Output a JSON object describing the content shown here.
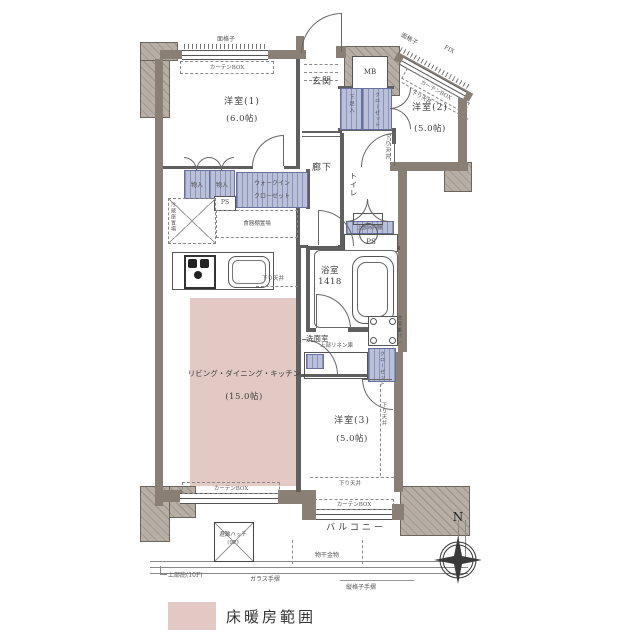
{
  "rooms": {
    "y1": {
      "name": "洋室(1)",
      "size": "(6.0帖)"
    },
    "y2": {
      "name": "洋室(2)",
      "size": "(5.0帖)"
    },
    "y3": {
      "name": "洋室(3)",
      "size": "(5.0帖)"
    },
    "ldk": {
      "name": "リビング・ダイニング・キッチン",
      "size": "(15.0帖)"
    },
    "genkan": "玄関",
    "rouka": "廊下",
    "toilet": "トイレ",
    "bath": {
      "name": "浴室",
      "size": "1418"
    },
    "senmen": "洗面室",
    "balcony": "バルコニー"
  },
  "fixtures": {
    "mb": "MB",
    "ps": "PS",
    "monoire": "物入",
    "gesokuire": "下足入",
    "closet": "クローゼット",
    "wic_line1": "ウォークイン",
    "wic_line2": "クローゼット",
    "linen_upper": "上部リネン庫",
    "hanging_cabinet": "上部吊戸棚",
    "fridge_space": "冷蔵庫置場",
    "cupboard_space": "食器棚置場",
    "washer_pan": "洗濯機パン"
  },
  "annotations": {
    "mengoshi": "面格子",
    "curtain_box": "カーテンBOX",
    "fix": "FIX",
    "sagari_tenjo": "下り天井",
    "evac_hatch": "避難ハッチ",
    "evac_floor": "(9F)",
    "monohoshi": "物干金物",
    "hisashi": "上部庇(10F)",
    "glass_rail": "ガラス手摺",
    "tategoshi_rail": "縦格子手摺"
  },
  "legend": {
    "floor_heating": "床暖房範囲"
  },
  "compass": {
    "n": "N"
  },
  "colors": {
    "wall": "#8a7f75",
    "closet": "#b9c0d7",
    "floor_heating": "#e2c9c4"
  }
}
